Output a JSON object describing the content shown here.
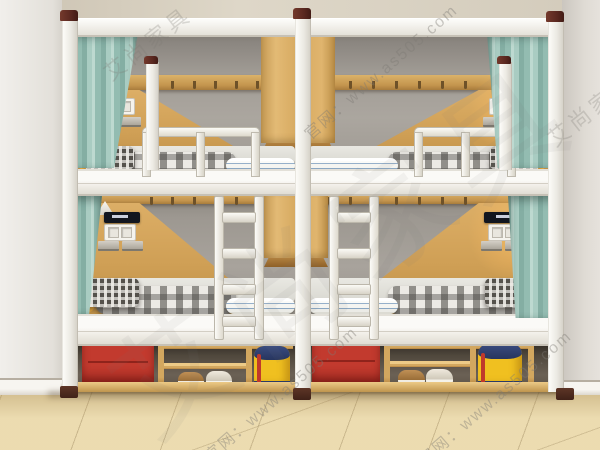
{
  "meta": {
    "description": "3D product render of a two-bay white steel dormitory bunk bed combo with teal privacy curtains, oak headboard panels, wall lamps, power sockets, center hanging lockers, two ladders and an under-bed storage cabinet holding red suitcases, shoes and yellow backpacks on a beige tiled floor.",
    "image_type": "product-photo"
  },
  "watermarks": {
    "brand": "艾尚家具",
    "site_line": "官网：www.as505.com",
    "url_fragment": "www.as505.com"
  },
  "palette": {
    "frame_white": "#f2f0ea",
    "curtain_teal": "#9fc3b9",
    "wood_oak": "#d3a55c",
    "bay_wall_gray": "#a29d96",
    "room_wall": "#eae7e2",
    "ceiling_beige": "#d5cdbd",
    "floor_tile": "#ead9ac",
    "suitcase_red": "#c23a2e",
    "backpack_yellow": "#f0c020",
    "backpack_navy": "#2e3f6e",
    "post_cap_brown": "#5a2820"
  },
  "objects": {
    "units": 2,
    "levels_per_unit": 2,
    "items": [
      "bunk bed frame",
      "privacy curtains",
      "wall lamps",
      "power sockets",
      "control panel",
      "coat hook strip",
      "hanging locker",
      "ladder",
      "guard rail",
      "plaid bedding",
      "pillows",
      "red suitcase",
      "yellow backpack",
      "shoes",
      "shoe shelf"
    ]
  }
}
